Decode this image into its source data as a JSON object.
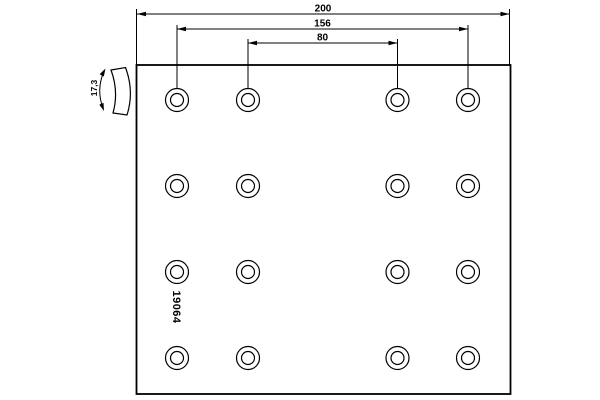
{
  "drawing": {
    "part_number": "19064",
    "dimensions": {
      "total_width": "200",
      "outer_hole_span": "156",
      "inner_hole_span": "80",
      "thickness": "17,3"
    },
    "hole_grid": {
      "cols_x": [
        177,
        248,
        397.5,
        468
      ],
      "rows_y": [
        100,
        186,
        272,
        358
      ],
      "outer_radius": 11.5,
      "inner_radius": 6.5
    },
    "colors": {
      "line": "#000000",
      "background": "#ffffff"
    }
  }
}
